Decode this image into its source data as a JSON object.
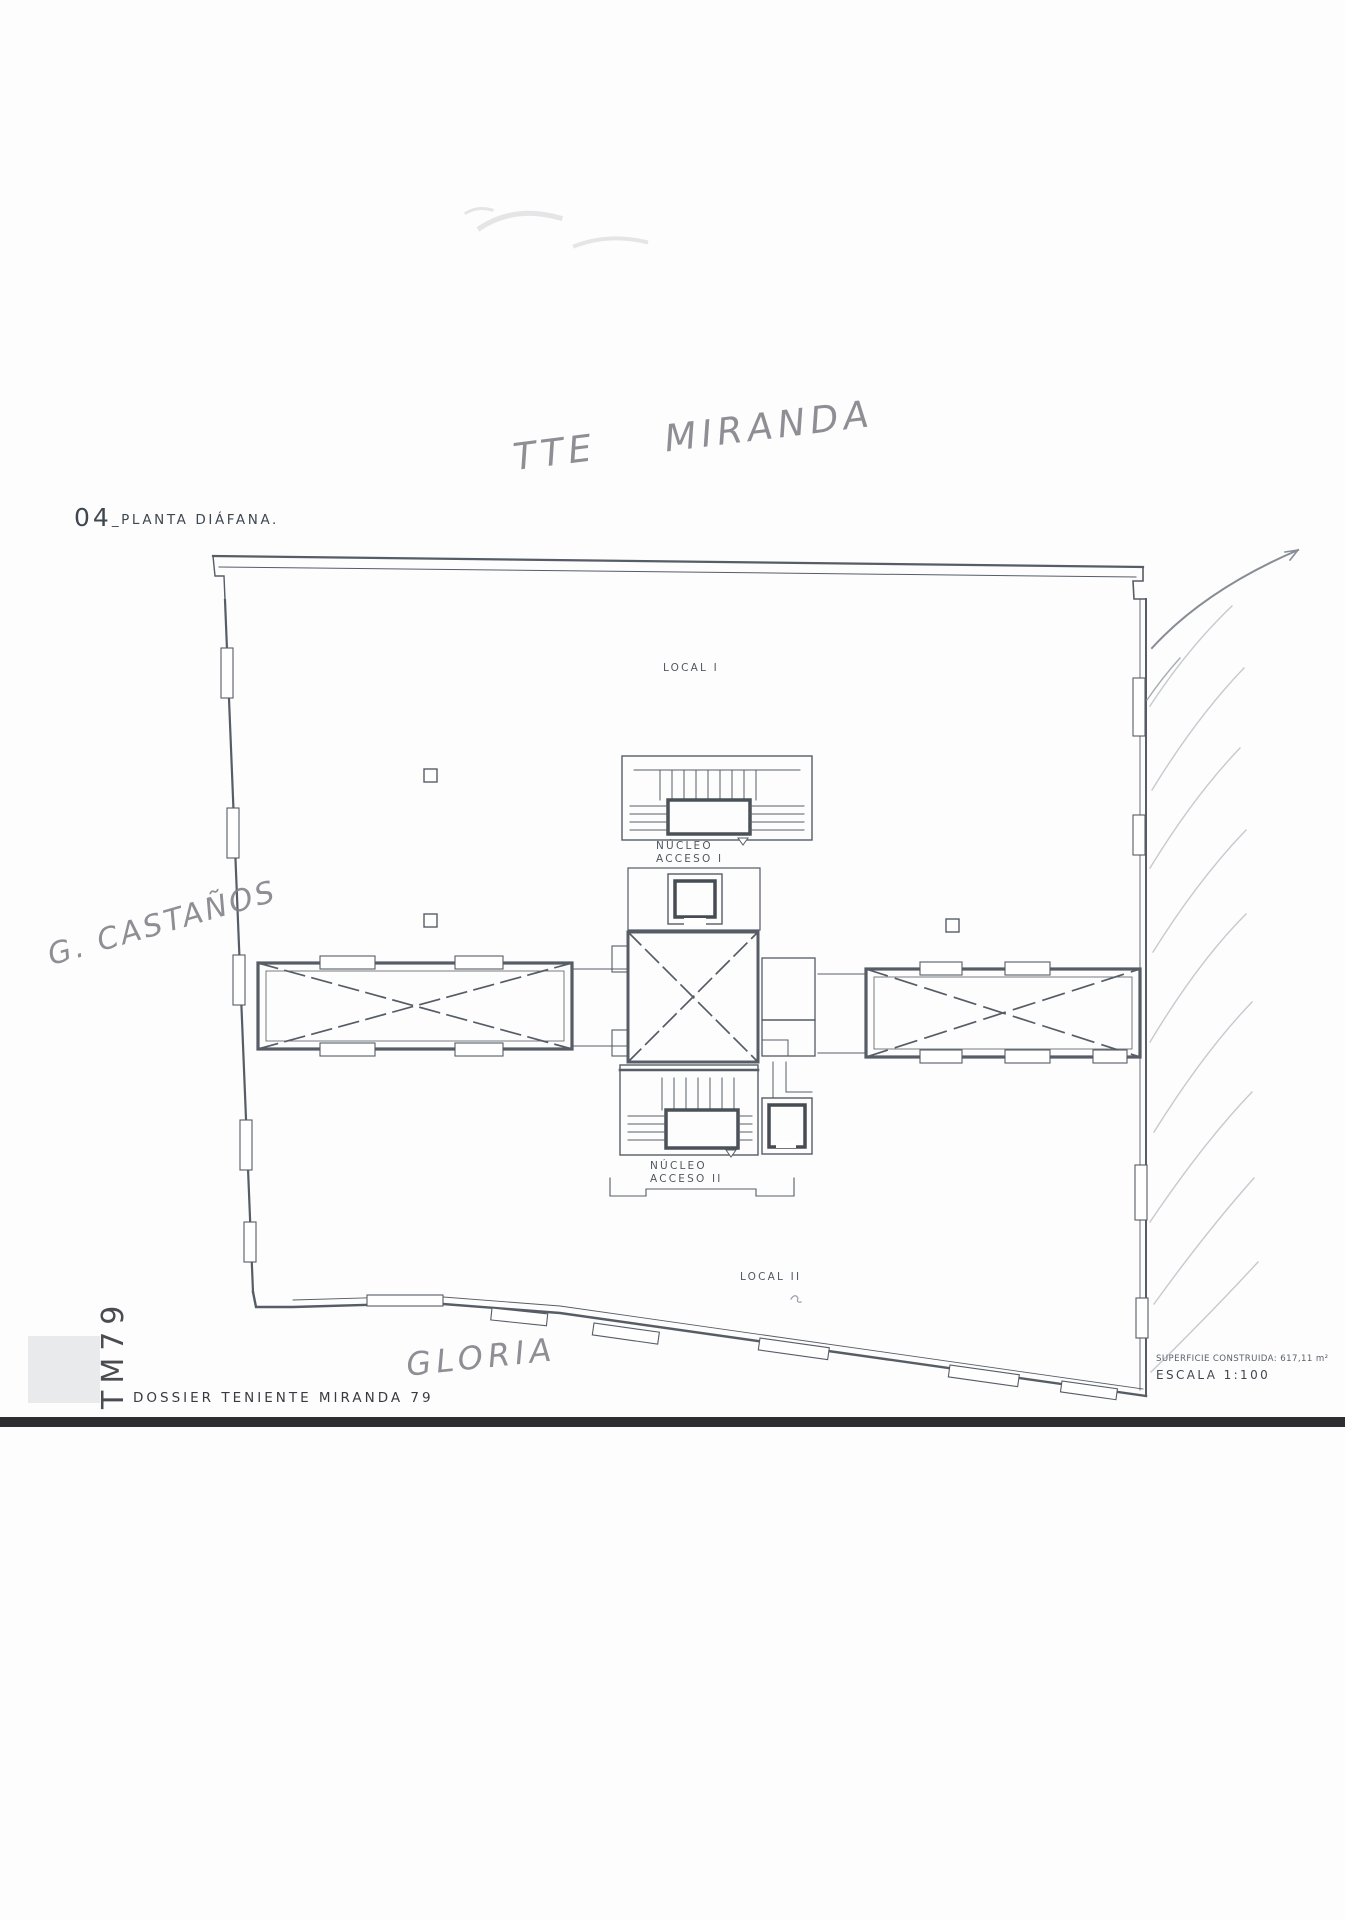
{
  "document": {
    "sheet_code": "04",
    "sheet_title": "_PLANTA DIÁFANA."
  },
  "plan": {
    "local_1": "LOCAL I",
    "local_2": "LOCAL II",
    "nucleo_1": {
      "line1": "NÚCLEO",
      "line2": "ACCESO I"
    },
    "nucleo_2": {
      "line1": "NÚCLEO",
      "line2": "ACCESO II"
    }
  },
  "handwriting": {
    "street_top": "TTE MIRANDA",
    "street_left": "G. CASTAÑOS",
    "street_bottom": "GLORIA"
  },
  "footer": {
    "project_code": "TM79",
    "dossier_title": "DOSSIER TENIENTE MIRANDA 79",
    "surface_note": "SUPERFICIE CONSTRUIDA: 617,11 m²",
    "scale_note": "ESCALA 1:100"
  },
  "colors": {
    "ink": "#565d66",
    "pencil": "#85858b",
    "rule_bar": "#2d2d32"
  }
}
